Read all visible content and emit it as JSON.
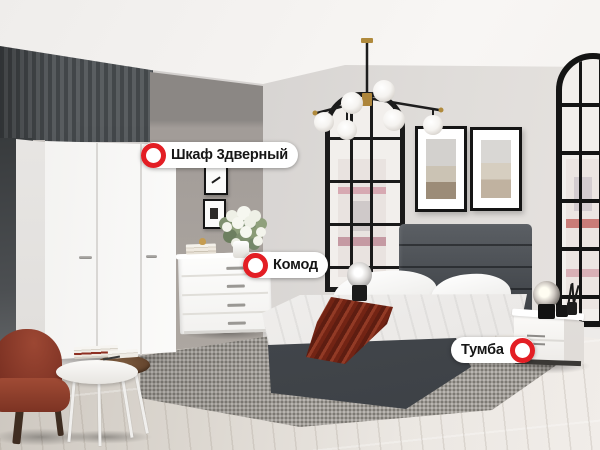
{
  "hotspots": [
    {
      "label": "Шкаф 3дверный",
      "marker_side": "left"
    },
    {
      "label": "Комод",
      "marker_side": "left"
    },
    {
      "label": "Тумба",
      "marker_side": "right"
    }
  ],
  "colors": {
    "marker_red": "#e31e24",
    "label_bg": "#ffffff",
    "label_text": "#161616",
    "accent_rust": "#7d2b1b",
    "headboard_grey": "#474b4f"
  }
}
